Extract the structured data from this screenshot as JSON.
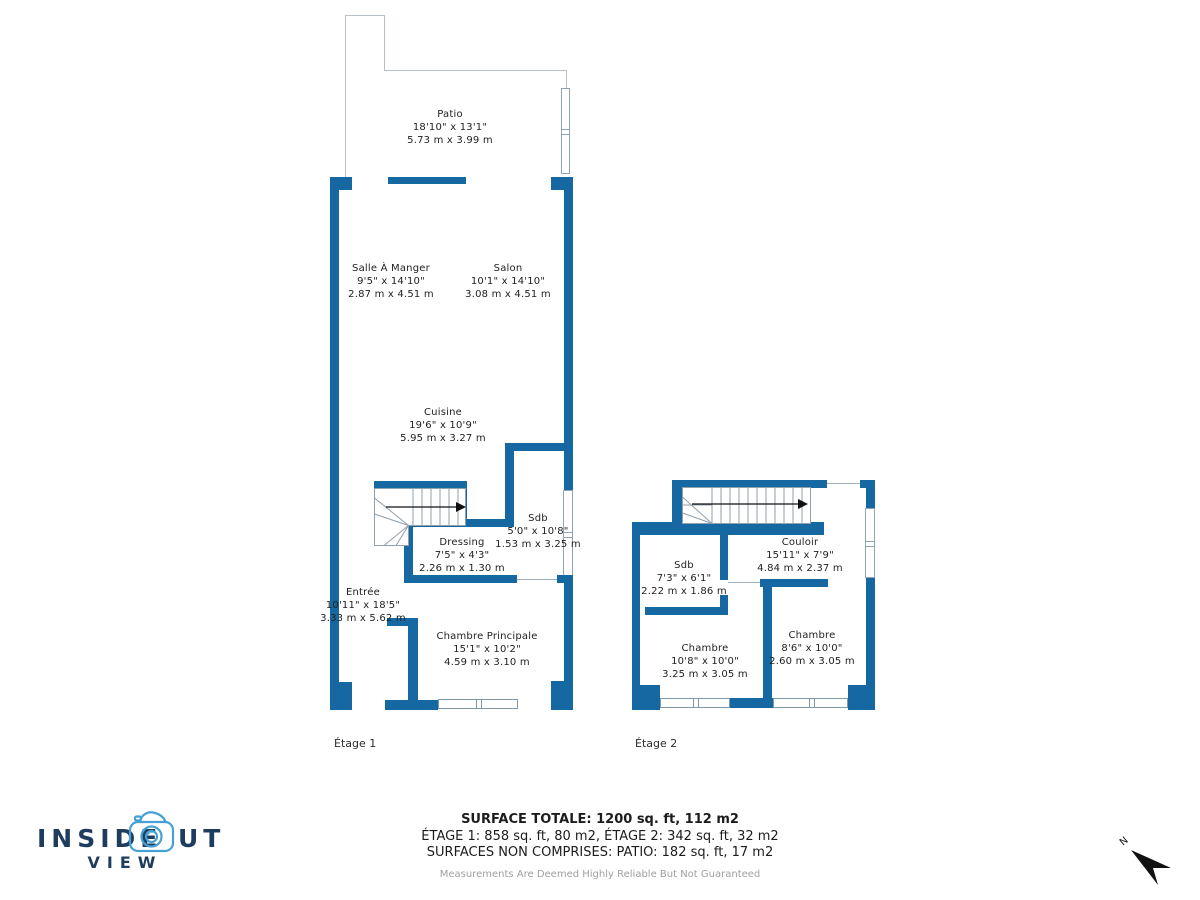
{
  "floors": [
    {
      "caption": "Étage 1",
      "rooms": [
        {
          "name": "Patio",
          "ft": "18'10\" x 13'1\"",
          "m": "5.73 m x 3.99 m"
        },
        {
          "name": "Salle À Manger",
          "ft": "9'5\" x 14'10\"",
          "m": "2.87 m x 4.51 m"
        },
        {
          "name": "Salon",
          "ft": "10'1\" x 14'10\"",
          "m": "3.08 m x 4.51 m"
        },
        {
          "name": "Cuisine",
          "ft": "19'6\" x 10'9\"",
          "m": "5.95 m x 3.27 m"
        },
        {
          "name": "Sdb",
          "ft": "5'0\" x 10'8\"",
          "m": "1.53 m x 3.25 m"
        },
        {
          "name": "Dressing",
          "ft": "7'5\" x 4'3\"",
          "m": "2.26 m x 1.30 m"
        },
        {
          "name": "Entrée",
          "ft": "10'11\" x 18'5\"",
          "m": "3.33 m x 5.62 m"
        },
        {
          "name": "Chambre Principale",
          "ft": "15'1\" x 10'2\"",
          "m": "4.59 m x 3.10 m"
        }
      ]
    },
    {
      "caption": "Étage 2",
      "rooms": [
        {
          "name": "Sdb",
          "ft": "7'3\" x 6'1\"",
          "m": "2.22 m x 1.86 m"
        },
        {
          "name": "Couloir",
          "ft": "15'11\" x 7'9\"",
          "m": "4.84 m x 2.37 m"
        },
        {
          "name": "Chambre",
          "ft": "10'8\" x 10'0\"",
          "m": "3.25 m x 3.05 m"
        },
        {
          "name": "Chambre",
          "ft": "8'6\" x 10'0\"",
          "m": "2.60 m x 3.05 m"
        }
      ]
    }
  ],
  "summary": {
    "total": "SURFACE TOTALE: 1200 sq. ft, 112 m2",
    "etages": "ÉTAGE 1: 858 sq. ft, 80 m2, ÉTAGE 2: 342 sq. ft, 32 m2",
    "non_comprises": "SURFACES NON COMPRISES: PATIO: 182 sq. ft, 17 m2",
    "disclaimer": "Measurements Are Deemed Highly Reliable But Not Guaranteed"
  },
  "logo": {
    "word_start": "INSIDE",
    "word_end": "UT",
    "sub": "VIEW"
  },
  "compass": {
    "north": "N"
  },
  "colors": {
    "wall": "#1568a2",
    "line": "#9fb0bd",
    "text": "#1f1f1f",
    "logo_navy": "#1e3c5e",
    "logo_blue": "#47a0d5",
    "muted": "#a0a0a0"
  }
}
